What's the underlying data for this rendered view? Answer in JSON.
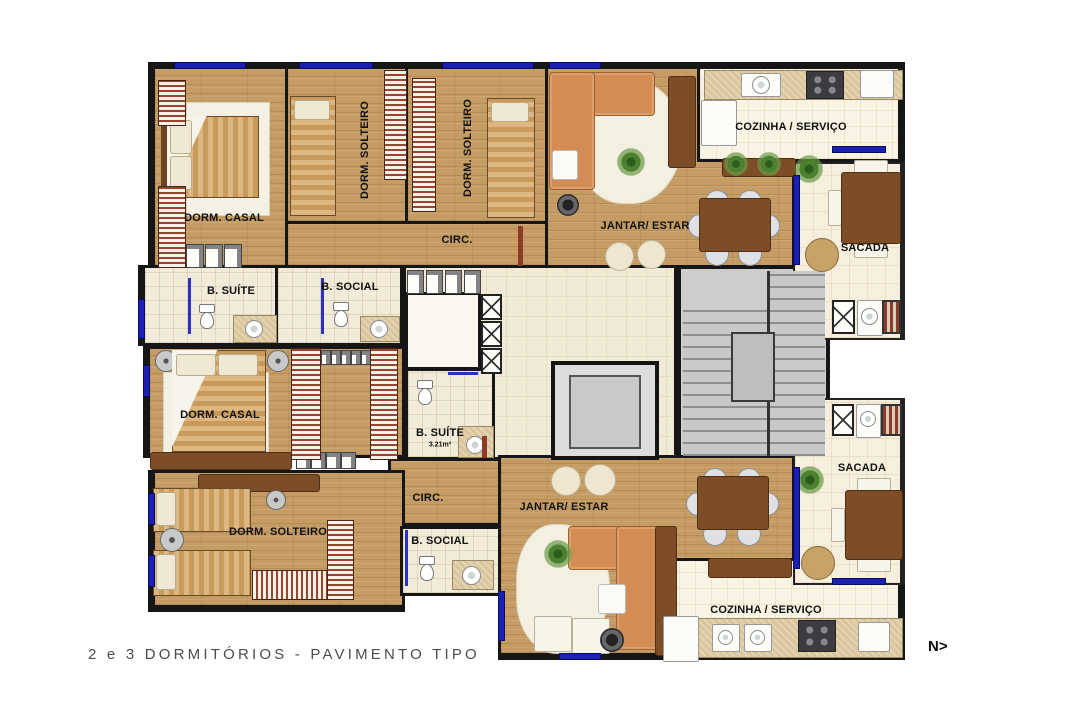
{
  "plan": {
    "caption": "2 e 3 DORMITÓRIOS - PAVIMENTO TIPO",
    "compass": "N>"
  },
  "unit_top": {
    "dorm_casal": "DORM. CASAL",
    "dorm_solteiro_a": "DORM. SOLTEIRO",
    "dorm_solteiro_b": "DORM. SOLTEIRO",
    "circ": "CIRC.",
    "b_suite": "B. SUÍTE",
    "b_social": "B. SOCIAL",
    "jantar_estar": "JANTAR/ ESTAR",
    "cozinha_servico": "COZINHA / SERVIÇO",
    "sacada": "SACADA"
  },
  "unit_bottom": {
    "dorm_casal": "DORM. CASAL",
    "b_suite": "B. SUÍTE",
    "b_suite_area": "3.21m²",
    "circ": "CIRC.",
    "dorm_solteiro": "DORM. SOLTEIRO",
    "b_social": "B. SOCIAL",
    "jantar_estar": "JANTAR/ ESTAR",
    "cozinha_servico": "COZINHA / SERVIÇO",
    "sacada": "SACADA"
  },
  "colors": {
    "wall": "#141414",
    "wood_floor": "#c59c64",
    "tile_floor": "#f2ebd9",
    "window_blue": "#1b20b2",
    "core_gray": "#cdcdcd",
    "sofa_orange": "#d28c54"
  }
}
